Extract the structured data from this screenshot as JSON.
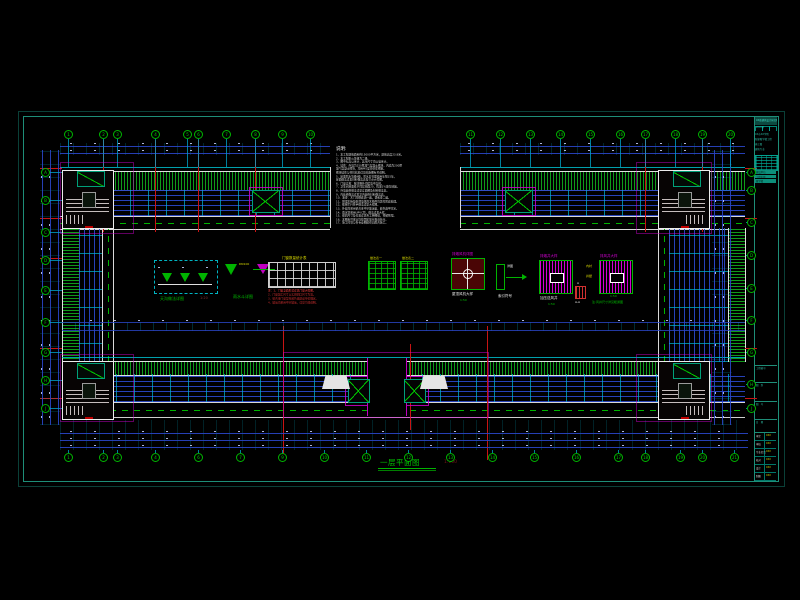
{
  "colors": {
    "frame_outer": "#0a4038",
    "frame_inner": "#1e8e78",
    "grid_green": "#00b400",
    "dim_blue": "#2a46c8",
    "red": "#c81414",
    "magenta": "#d400d4",
    "yellow": "#d8d800",
    "white": "#e8e8e8"
  },
  "drawing": {
    "title": "一层平面图",
    "scale": "1:100"
  },
  "notes": {
    "title": "说明:",
    "lines": [
      "1、本工程建筑面积约15000平方米，建筑高度23.8米。",
      "2、本工程耐火等级为二级。",
      "3、图中标高以米计，其余尺寸均以毫米计。",
      "4、墙体：外墙为250厚加气混凝土砌块，内墙为200厚",
      "   加气混凝土砌块，均用M5混合砂浆砌筑。",
      "   砌块墙体与柱拉结筋详见结施图有关说明。",
      "5、屋面防水等级Ⅱ级，防水层合理使用年限15年，",
      "   屋面做法详见材料做法表及节点大样图。",
      "6、门窗立樘：除注明外均居墙中立樘。",
      "7、卫生间地面低于同层地面20，找坡1%坡向地漏。",
      "8、外墙装修做法详见立面图及材料做法表。",
      "9、内装修做法详见室内装修材料做法表。",
      "10、油漆：木门均刷底油一遍，调和漆二遍。",
      "11、预埋木砖及贴邻墙体的木构件均需作防腐处理。",
      "12、楼梯栏杆扶手做法详见大样图。",
      "13、外窗均采用铝合金中空玻璃窗，颜色由甲方定。",
      "14、雨水管采用UPVC管，做法详见大样。",
      "15、留洞尺寸及位置详见各工种图纸，预留预埋。",
      "16、本图未尽事宜均按国家现行规范执行。",
      "17、施工时须与各专业图纸密切配合施工。"
    ]
  },
  "legend": {
    "gutter": {
      "label": "天沟做法详图",
      "scale": "1:20",
      "dn": "DN100"
    },
    "hopper": {
      "label": "雨水斗详图",
      "dn": "DN100"
    },
    "window_table": {
      "title": "门窗数量统计表",
      "red_lines": [
        "注：1、门窗立面形式详见门窗大样图。",
        "2、门窗加工尺寸以实测洞口尺寸为准。",
        "3、铝合金门窗型材颜色由建设单位确定。",
        "4、玻璃均采用中空玻璃，详见节能说明。"
      ]
    },
    "mat_table1": {
      "title": "做法表一"
    },
    "mat_table2": {
      "title": "做法表二"
    },
    "fan": {
      "title": "排烟风机详图",
      "label": "屋顶风机大样",
      "scale": "1:50"
    },
    "index": {
      "label": "索引符号",
      "tag": "详图"
    },
    "shaft1": {
      "title": "排烟井大样",
      "label": "加压送风井",
      "scale": "1:50"
    },
    "section": {
      "top": "A",
      "bottom": "A-A"
    },
    "shaft2": {
      "title": "排风井大样",
      "scale": "1:50",
      "note": "注:风井尺寸详见暖通图",
      "a1": "内衬",
      "a2": "井壁"
    }
  },
  "title_block": {
    "firm": "XX省建筑设计研究院",
    "cert": "证书甲级",
    "project_lines": [
      "XX市XX学院",
      "新建教学楼工程",
      "施工图",
      "建筑专业"
    ],
    "highlight_rows": [
      "建设单位",
      "工程名称",
      "教学楼"
    ],
    "section_labels": [
      {
        "label": "工程编号",
        "y": 365
      },
      {
        "label": "图　别",
        "y": 382
      },
      {
        "label": "图　号",
        "y": 401
      },
      {
        "label": "日　期",
        "y": 419
      }
    ],
    "sig_rows": [
      {
        "label": "审定",
        "value": "XXX"
      },
      {
        "label": "审核",
        "value": "XXX"
      },
      {
        "label": "专业负责",
        "value": "XXX"
      },
      {
        "label": "校对",
        "value": "XXX"
      },
      {
        "label": "设计",
        "value": "XXX"
      },
      {
        "label": "制图",
        "value": "XXX"
      }
    ]
  },
  "grid": {
    "rows": [
      {
        "orient": "h",
        "y": 134,
        "leader_to": 167,
        "items": [
          {
            "x": 68,
            "label": "1"
          },
          {
            "x": 103,
            "label": "2"
          },
          {
            "x": 117,
            "label": "3"
          },
          {
            "x": 155,
            "label": "4"
          },
          {
            "x": 187,
            "label": "5"
          },
          {
            "x": 198,
            "label": "6"
          },
          {
            "x": 226,
            "label": "7"
          },
          {
            "x": 255,
            "label": "8"
          },
          {
            "x": 282,
            "label": "9"
          },
          {
            "x": 310,
            "label": "10"
          }
        ]
      },
      {
        "orient": "h",
        "y": 134,
        "leader_to": 167,
        "items": [
          {
            "x": 470,
            "label": "11"
          },
          {
            "x": 500,
            "label": "12"
          },
          {
            "x": 530,
            "label": "13"
          },
          {
            "x": 560,
            "label": "14"
          },
          {
            "x": 590,
            "label": "15"
          },
          {
            "x": 620,
            "label": "16"
          },
          {
            "x": 645,
            "label": "17"
          },
          {
            "x": 675,
            "label": "18"
          },
          {
            "x": 702,
            "label": "19"
          },
          {
            "x": 730,
            "label": "20"
          }
        ]
      },
      {
        "orient": "h",
        "y": 457,
        "leader_to": 450,
        "items": [
          {
            "x": 68,
            "label": "1"
          },
          {
            "x": 103,
            "label": "2"
          },
          {
            "x": 117,
            "label": "3"
          },
          {
            "x": 155,
            "label": "4"
          },
          {
            "x": 198,
            "label": "6"
          },
          {
            "x": 240,
            "label": "7"
          },
          {
            "x": 282,
            "label": "9"
          },
          {
            "x": 324,
            "label": "10"
          },
          {
            "x": 366,
            "label": "11"
          },
          {
            "x": 408,
            "label": "12"
          },
          {
            "x": 450,
            "label": "13"
          },
          {
            "x": 492,
            "label": "14"
          },
          {
            "x": 534,
            "label": "15"
          },
          {
            "x": 576,
            "label": "16"
          },
          {
            "x": 618,
            "label": "17"
          },
          {
            "x": 645,
            "label": "18"
          },
          {
            "x": 680,
            "label": "19"
          },
          {
            "x": 702,
            "label": "20"
          },
          {
            "x": 734,
            "label": "21"
          }
        ]
      },
      {
        "orient": "v",
        "x": 45,
        "leader_to": 62,
        "items": [
          {
            "y": 172,
            "label": "A"
          },
          {
            "y": 200,
            "label": "B"
          },
          {
            "y": 232,
            "label": "C"
          },
          {
            "y": 260,
            "label": "D"
          },
          {
            "y": 290,
            "label": "E"
          },
          {
            "y": 322,
            "label": "F"
          },
          {
            "y": 352,
            "label": "G"
          },
          {
            "y": 380,
            "label": "H"
          },
          {
            "y": 408,
            "label": "J"
          }
        ]
      },
      {
        "orient": "v",
        "x": 751,
        "leader_to": 746,
        "items": [
          {
            "y": 172,
            "label": "A"
          },
          {
            "y": 190,
            "label": "B"
          },
          {
            "y": 222,
            "label": "C"
          },
          {
            "y": 255,
            "label": "D"
          },
          {
            "y": 288,
            "label": "E"
          },
          {
            "y": 320,
            "label": "F"
          },
          {
            "y": 352,
            "label": "G"
          },
          {
            "y": 384,
            "label": "H"
          },
          {
            "y": 408,
            "label": "J"
          }
        ]
      }
    ]
  }
}
